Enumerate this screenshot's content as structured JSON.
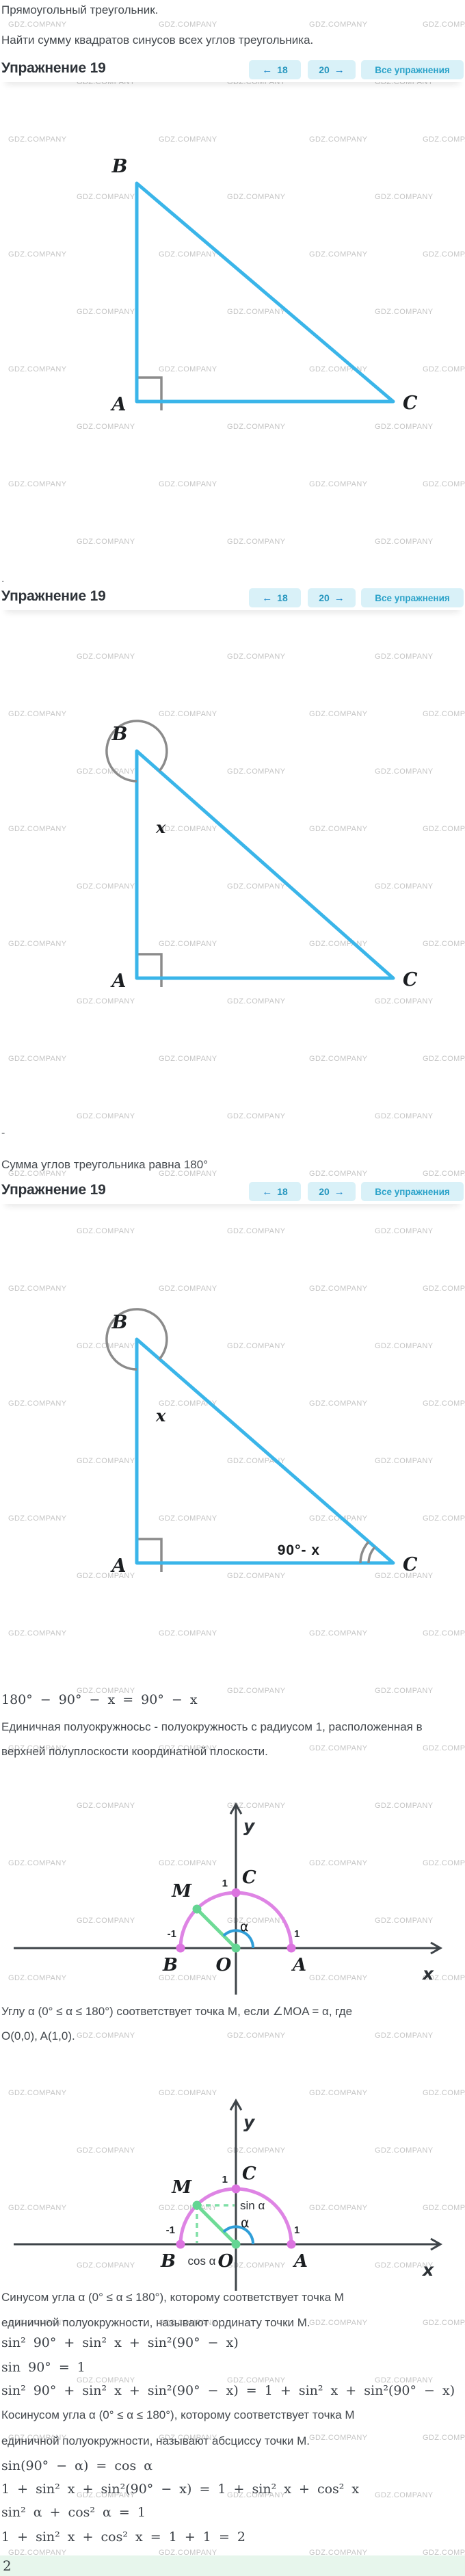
{
  "watermark": {
    "text": "GDZ.COMPANY"
  },
  "intro": {
    "line1": "Прямоугольный треугольник.",
    "line2": "Найти сумму квадратов синусов всех углов треугольника."
  },
  "nav": {
    "title": "Упражнение 19",
    "prev_arrow": "←",
    "prev_label": "18",
    "next_label": "20",
    "next_arrow": "→",
    "all_label": "Все упражнения"
  },
  "separators": {
    "dot": ".",
    "dash": "-"
  },
  "statements": {
    "sum_of_angles": "Сумма углов треугольника равна 180°",
    "unit_semicircle_1": "Единичная полуокружносьс - полуокружность с радиусом 1, расположенная в",
    "unit_semicircle_2": "верхней полуплоскости координатной плоскости.",
    "angle_point_1": "Углу α (0° ≤ α ≤ 180°) соответствует точка M, если ∠MOA = α, где",
    "angle_point_2": "O(0,0), A(1,0).",
    "sine_def_1": "Синусом угла α (0° ≤ α ≤ 180°), которому соответствует точка M",
    "sine_def_2": "единичной полуокружности, называют ординату точки M.",
    "cosine_def_1": "Косинусом угла α (0° ≤ α ≤ 180°), которому соответствует точка M",
    "cosine_def_2": "единичной полуокружности, называют абсциссу точки M."
  },
  "formulas": {
    "angle_c": "180° − 90° − x = 90° − x",
    "sum_squares": "sin² 90° + sin² x + sin²(90° − x)",
    "sin_90": "sin 90° = 1",
    "substitute": "sin² 90° + sin² x + sin²(90° − x) = 1 + sin² x + sin²(90° − x)",
    "cofunction": "sin(90° − α) = cos α",
    "replace": "1 + sin² x + sin²(90° − x) = 1 + sin² x + cos² x",
    "pythagorean": "sin² α + cos² α = 1",
    "result": "1 + sin² x + cos² x = 1 + 1 = 2"
  },
  "answer": {
    "value": "2"
  },
  "triangle": {
    "a": "A",
    "b": "B",
    "c": "C",
    "angle_b": "x",
    "angle_c": "90°- x"
  },
  "plot": {
    "x": "x",
    "y": "y",
    "o": "O",
    "a": "A",
    "b": "B",
    "c": "C",
    "m": "M",
    "alpha": "α",
    "one": "1",
    "minus_one": "-1",
    "sin_alpha": "sin α",
    "cos_alpha": "cos α"
  },
  "colors": {
    "triangle_stroke": "#3ab5e9",
    "right_angle_gray": "#8b8b8b",
    "semicircle": "#de84e4",
    "point_magenta": "#dc74e0",
    "green": "#6edb96",
    "angle_arc_blue": "#2f9ed8",
    "accent": "#2aa2c9",
    "button_bg": "#d9f1f8",
    "watermark": "#c4c4c4",
    "answer_bg": "#e7f6ec"
  }
}
